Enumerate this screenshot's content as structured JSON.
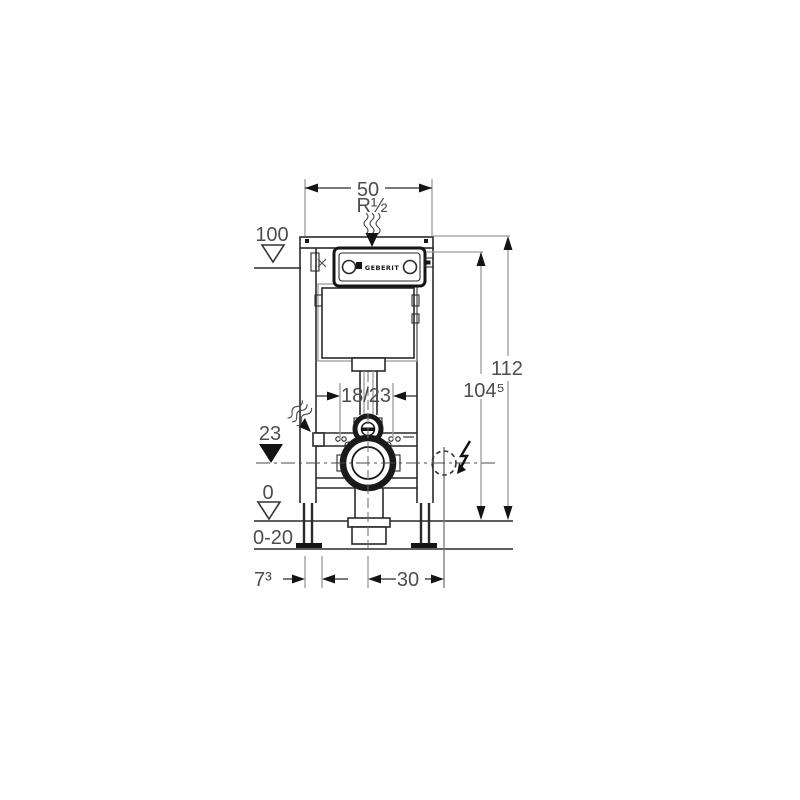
{
  "drawing": {
    "type": "technical-installation-diagram",
    "subject": "wall-mounted WC element front view with dimensions (cm)",
    "brand_label": "GEBERIT",
    "dimensions": {
      "width_top": "50",
      "water_supply": "R½",
      "level_upper": "100",
      "height_total": "112",
      "height_cistern_top": "104⁵",
      "fixing_spread": "18/23",
      "outlet_height": "23",
      "floor_level": "0",
      "floor_range": "0-20",
      "left_offset": "7³",
      "electrical_offset": "30"
    },
    "icons": {
      "water_flow": "wavy-lines",
      "electrical": "lightning-bolt",
      "datum_open": "open-triangle",
      "datum_filled": "filled-triangle",
      "electrical_point": "dashed-circle"
    },
    "colors": {
      "background": "#ffffff",
      "structure_line": "#2a2a2a",
      "dimension_line": "#9c9c9c",
      "dimension_text": "#4d4d4d",
      "arrow_fill": "#141414"
    }
  }
}
